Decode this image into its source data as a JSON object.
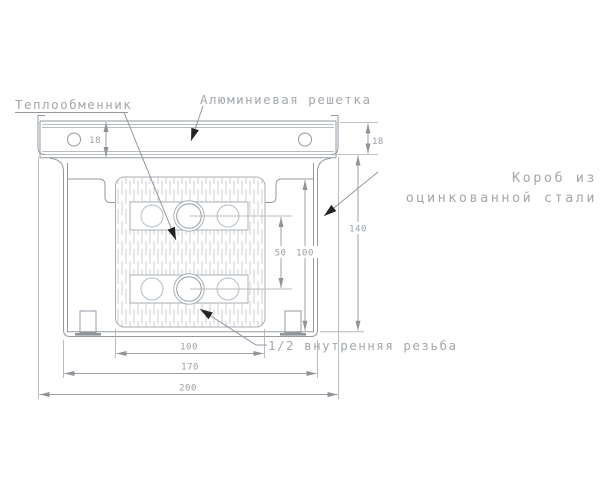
{
  "drawing": {
    "labels": {
      "heat_exchanger": "Теплообменник",
      "aluminum_grille": "Алюминиевая решетка",
      "steel_box_line1": "Короб из",
      "steel_box_line2": "оцинкованной стали",
      "thread": "1/2 внутренняя резьба"
    },
    "dimensions": {
      "grille_height_left": "18",
      "grille_height_right": "18",
      "box_height": "140",
      "inner_height": "100",
      "tube_pitch": "50",
      "exchanger_width": "100",
      "box_width": "170",
      "overall_width": "200"
    },
    "colors": {
      "line": "#939aa0",
      "secondary_line": "#b7bdc2",
      "hatch": "#c9cdd1",
      "text": "#a3a8ad",
      "arrowhead": "#242424",
      "background": "#ffffff"
    }
  }
}
